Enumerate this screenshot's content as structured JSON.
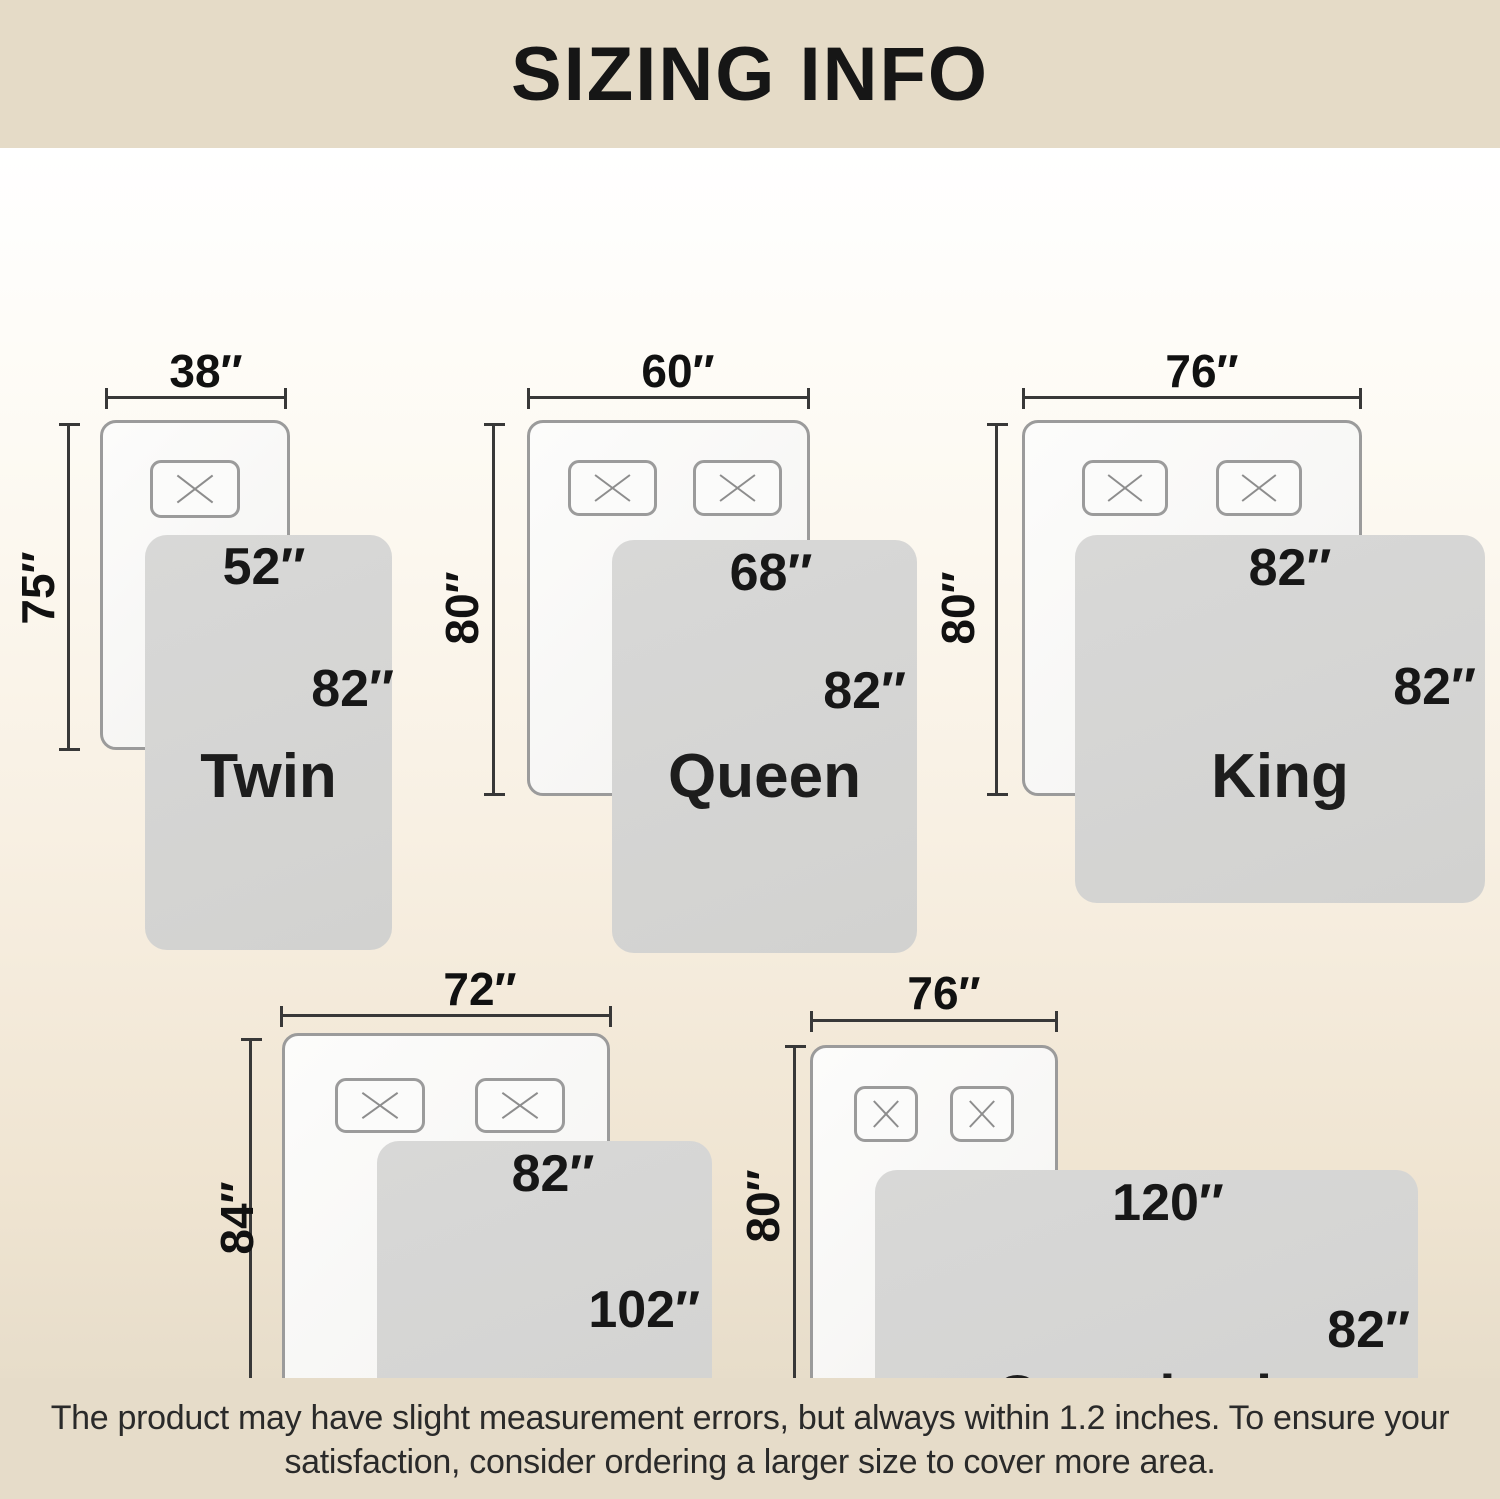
{
  "header": {
    "title": "SIZING INFO"
  },
  "footer": {
    "line1": "The product may have slight measurement errors, but always within 1.2 inches. To ensure your",
    "line2": "satisfaction, consider ordering a larger size to cover more area."
  },
  "palette": {
    "band_beige": "#e5dbc7",
    "background_top": "#ffffff",
    "background_bottom": "#e7ddca",
    "blanket_gray": "#d5d5d4",
    "mattress_white": "#f9f9f8",
    "outline_gray": "#9b9b9b",
    "dimension_line": "#383838",
    "text_black": "#171717"
  },
  "sizes": [
    {
      "name": "Twin",
      "pillows": 1,
      "mattress_width": "38″",
      "mattress_height": "75″",
      "blanket_width": "52″",
      "blanket_length": "82″"
    },
    {
      "name": "Queen",
      "pillows": 2,
      "mattress_width": "60″",
      "mattress_height": "80″",
      "blanket_width": "68″",
      "blanket_length": "82″"
    },
    {
      "name": "King",
      "pillows": 2,
      "mattress_width": "76″",
      "mattress_height": "80″",
      "blanket_width": "82″",
      "blanket_length": "82″"
    },
    {
      "name": "California\nKing",
      "pillows": 2,
      "mattress_width": "72″",
      "mattress_height": "84″",
      "blanket_width": "82″",
      "blanket_length": "102″"
    },
    {
      "name": "Oversized\nKing",
      "pillows": 2,
      "mattress_width": "76″",
      "mattress_height": "80″",
      "blanket_width": "120″",
      "blanket_length": "82″"
    }
  ]
}
